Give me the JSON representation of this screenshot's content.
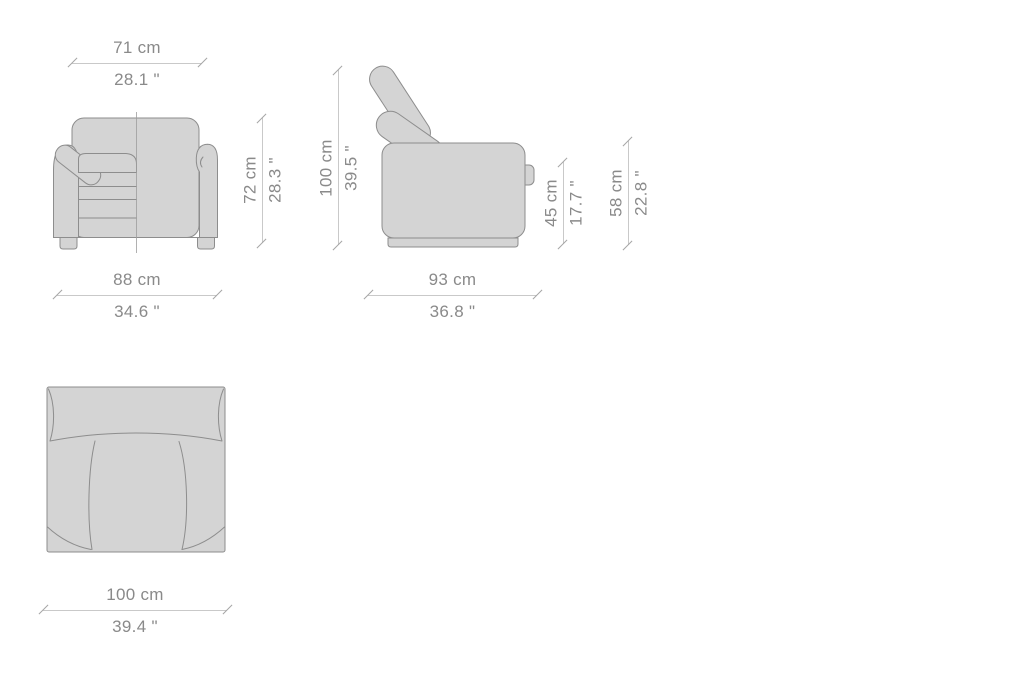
{
  "page": {
    "background": "#ffffff"
  },
  "colors": {
    "furniture_fill": "#d4d4d4",
    "furniture_outline": "#8d8d8d",
    "dimension_line": "#c9c9c9",
    "tick": "#a6a6a6",
    "label_text": "#8a8a8a"
  },
  "views": {
    "front": {
      "label": "front-view",
      "dims": {
        "seat_width": {
          "cm": "71 cm",
          "inch": "28.1 \""
        },
        "height": {
          "cm": "72 cm",
          "inch": "28.3 \""
        },
        "overall_width": {
          "cm": "88 cm",
          "inch": "34.6 \""
        }
      }
    },
    "side": {
      "label": "side-view",
      "dims": {
        "overall_height": {
          "cm": "100 cm",
          "inch": "39.5 \""
        },
        "seat_height": {
          "cm": "45 cm",
          "inch": "17.7 \""
        },
        "arm_height": {
          "cm": "58 cm",
          "inch": "22.8 \""
        },
        "depth": {
          "cm": "93 cm",
          "inch": "36.8 \""
        }
      }
    },
    "top": {
      "label": "top-view",
      "dims": {
        "overall_width": {
          "cm": "100 cm",
          "inch": "39.4 \""
        }
      }
    }
  }
}
